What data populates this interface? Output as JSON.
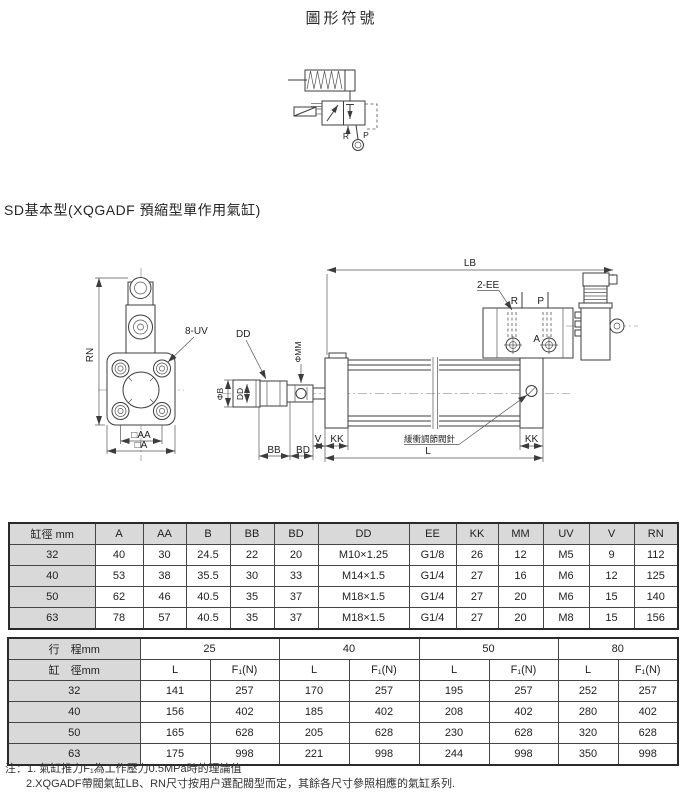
{
  "page": {
    "title": "圖形符號",
    "section_heading": "SD基本型(XQGADF 預縮型單作用氣缸)"
  },
  "symbol": {
    "r": "R",
    "p": "P"
  },
  "drawing": {
    "labels": {
      "rn": "RN",
      "uv": "8-UV",
      "sq_aa": "□AA",
      "sq_a": "□A",
      "dd_top": "DD",
      "phi_b": "ΦB",
      "dd_vert": "DD",
      "phi_mm": "ΦMM",
      "bb": "BB",
      "bd": "BD",
      "lb": "LB",
      "ee": "2-EE",
      "r": "R",
      "p": "P",
      "a": "A",
      "v": "V",
      "kk_left": "KK",
      "kk_right": "KK",
      "l": "L",
      "cushion": "緩衝調節閥針"
    }
  },
  "table1": {
    "headers": [
      "缸徑 mm",
      "A",
      "AA",
      "B",
      "BB",
      "BD",
      "DD",
      "EE",
      "KK",
      "MM",
      "UV",
      "V",
      "RN"
    ],
    "rows": [
      [
        "32",
        "40",
        "30",
        "24.5",
        "22",
        "20",
        "M10×1.25",
        "G1/8",
        "26",
        "12",
        "M5",
        "9",
        "112"
      ],
      [
        "40",
        "53",
        "38",
        "35.5",
        "30",
        "33",
        "M14×1.5",
        "G1/4",
        "27",
        "16",
        "M6",
        "12",
        "125"
      ],
      [
        "50",
        "62",
        "46",
        "40.5",
        "35",
        "37",
        "M18×1.5",
        "G1/4",
        "27",
        "20",
        "M6",
        "15",
        "140"
      ],
      [
        "63",
        "78",
        "57",
        "40.5",
        "35",
        "37",
        "M18×1.5",
        "G1/4",
        "27",
        "20",
        "M8",
        "15",
        "156"
      ]
    ]
  },
  "table2": {
    "stroke_header": "行　程mm",
    "bore_header": "缸　徑mm",
    "strokes": [
      "25",
      "40",
      "50",
      "80"
    ],
    "sub_headers": [
      "L",
      "F₁(N)"
    ],
    "rows": [
      [
        "32",
        "141",
        "257",
        "170",
        "257",
        "195",
        "257",
        "252",
        "257"
      ],
      [
        "40",
        "156",
        "402",
        "185",
        "402",
        "208",
        "402",
        "280",
        "402"
      ],
      [
        "50",
        "165",
        "628",
        "205",
        "628",
        "230",
        "628",
        "320",
        "628"
      ],
      [
        "63",
        "175",
        "998",
        "221",
        "998",
        "244",
        "998",
        "350",
        "998"
      ]
    ]
  },
  "notes": {
    "line1": "注：1. 氣缸推力F₁為工作壓力0.5MPa時的理論值",
    "line2": "2.XQGADF帶閥氣缸LB、RN尺寸按用户選配閥型而定，其餘各尺寸參照相應的氣缸系列."
  }
}
